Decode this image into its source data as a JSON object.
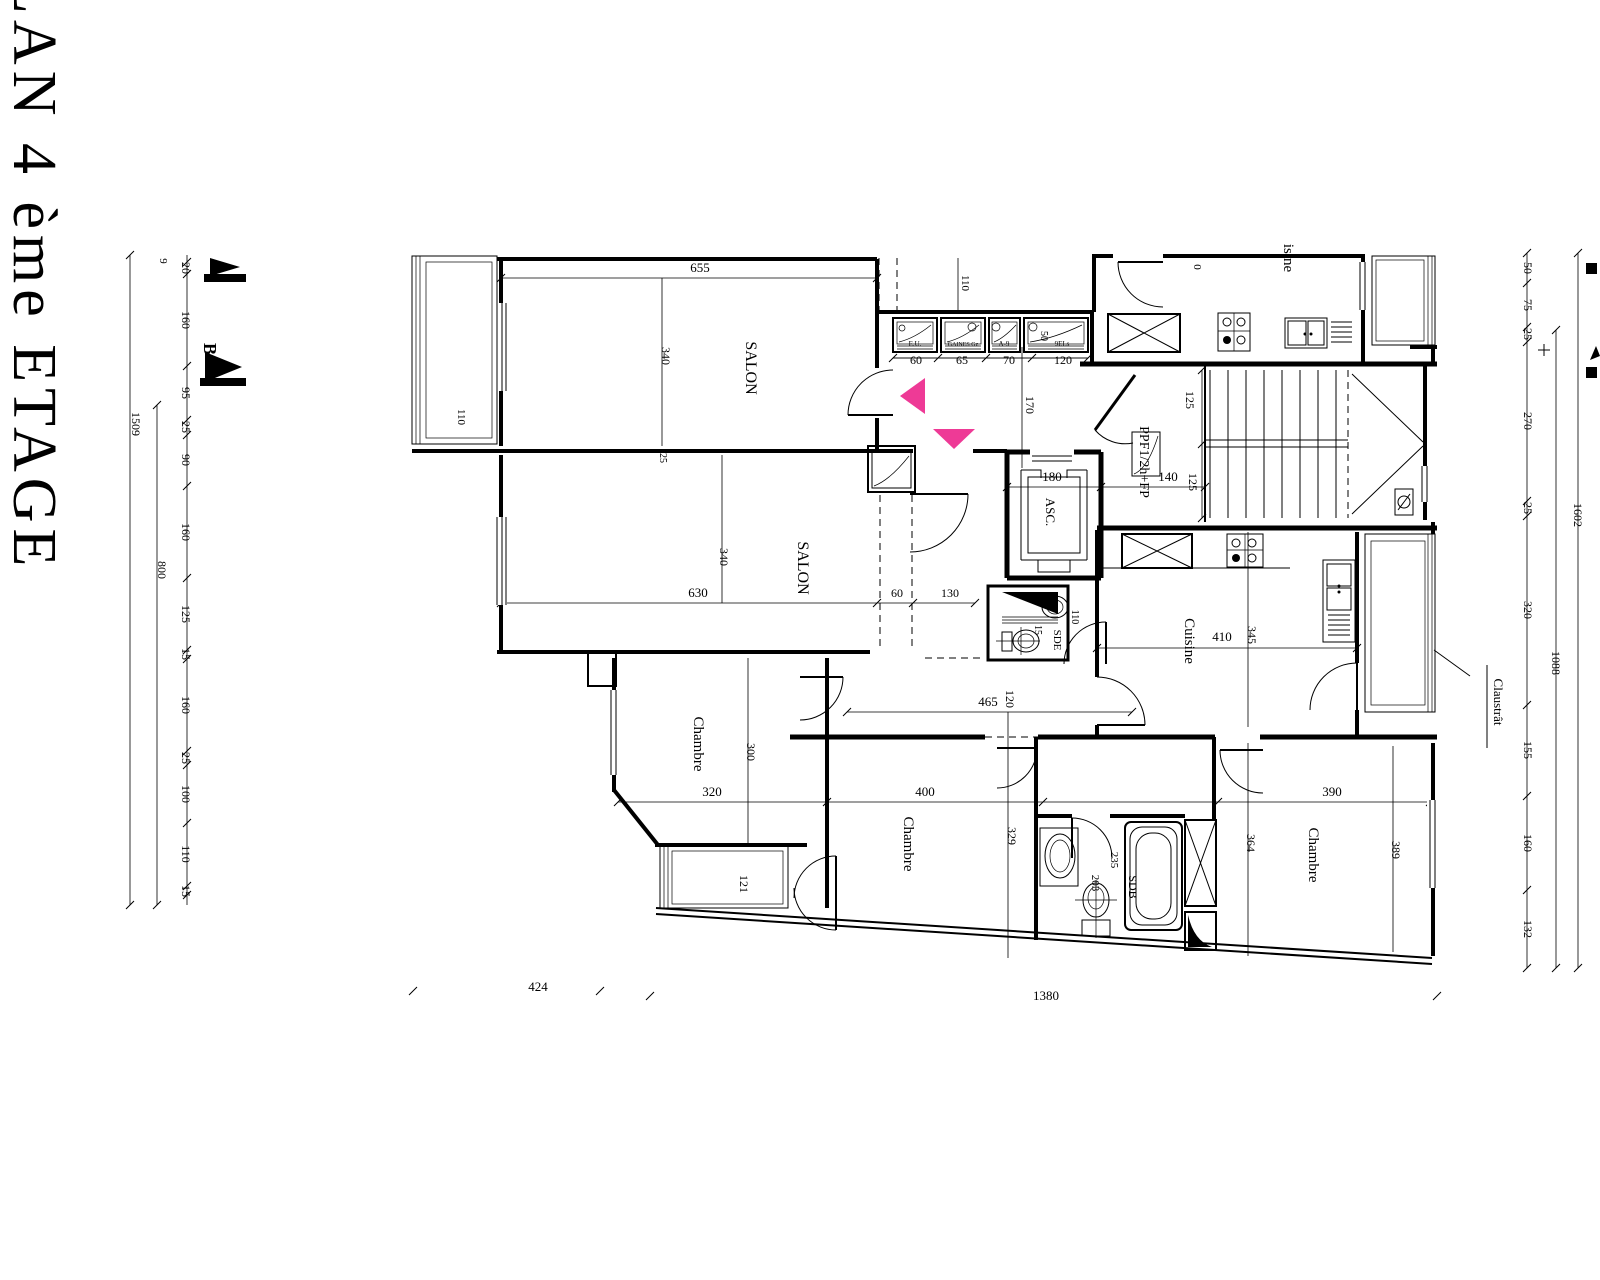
{
  "title": "PLAN 4 ème ETAGE",
  "colors": {
    "ink": "#000000",
    "background": "#ffffff",
    "highlight_arrow": "#ee3a96"
  },
  "drawing": {
    "labels": [
      {
        "n": "plan-title",
        "t": "PLAN 4 ème ETAGE",
        "x": 14,
        "y": 254,
        "r": 90,
        "s": 62,
        "ls": 6
      },
      {
        "n": "chain-total-1509",
        "t": "1509",
        "x": 132,
        "y": 424,
        "r": 90,
        "s": 12
      },
      {
        "n": "chain-total-800",
        "t": "800",
        "x": 158,
        "y": 570,
        "r": 90,
        "s": 12
      },
      {
        "n": "chain-partial-9",
        "t": "9",
        "x": 160,
        "y": 261,
        "r": 90,
        "s": 11
      },
      {
        "n": "section-marker-b",
        "t": "B",
        "x": 204,
        "y": 349,
        "r": 90,
        "s": 18,
        "w": "bold"
      },
      {
        "n": "chain-l-20",
        "t": "20",
        "x": 182,
        "y": 268,
        "r": 90,
        "s": 12
      },
      {
        "n": "chain-l-160a",
        "t": "160",
        "x": 182,
        "y": 320,
        "r": 90,
        "s": 12
      },
      {
        "n": "chain-l-95",
        "t": "95",
        "x": 182,
        "y": 393,
        "r": 90,
        "s": 12
      },
      {
        "n": "chain-l-25a",
        "t": "25",
        "x": 182,
        "y": 427,
        "r": 90,
        "s": 12
      },
      {
        "n": "chain-l-90",
        "t": "90",
        "x": 182,
        "y": 460,
        "r": 90,
        "s": 12
      },
      {
        "n": "chain-l-160b",
        "t": "160",
        "x": 182,
        "y": 532,
        "r": 90,
        "s": 12
      },
      {
        "n": "chain-l-125",
        "t": "125",
        "x": 182,
        "y": 614,
        "r": 90,
        "s": 12
      },
      {
        "n": "chain-l-15a",
        "t": "15",
        "x": 182,
        "y": 654,
        "r": 90,
        "s": 12
      },
      {
        "n": "chain-l-160c",
        "t": "160",
        "x": 182,
        "y": 705,
        "r": 90,
        "s": 12
      },
      {
        "n": "chain-l-25b",
        "t": "25",
        "x": 182,
        "y": 758,
        "r": 90,
        "s": 12
      },
      {
        "n": "chain-l-100",
        "t": "100",
        "x": 182,
        "y": 794,
        "r": 90,
        "s": 12
      },
      {
        "n": "chain-l-110",
        "t": "110",
        "x": 182,
        "y": 854,
        "r": 90,
        "s": 12
      },
      {
        "n": "chain-l-15b",
        "t": "15",
        "x": 182,
        "y": 891,
        "r": 90,
        "s": 12
      },
      {
        "n": "dim-655",
        "t": "655",
        "x": 700,
        "y": 272,
        "r": 0,
        "s": 13
      },
      {
        "n": "dim-110-balcony",
        "t": "110",
        "x": 458,
        "y": 417,
        "r": 90,
        "s": 11
      },
      {
        "n": "room-salon-1",
        "t": "SALON",
        "x": 746,
        "y": 368,
        "r": 90,
        "s": 16
      },
      {
        "n": "dim-340-salon1",
        "t": "340",
        "x": 662,
        "y": 356,
        "r": 90,
        "s": 12
      },
      {
        "n": "dim-110-top",
        "t": "110",
        "x": 962,
        "y": 283,
        "r": 90,
        "s": 11
      },
      {
        "n": "duct-label-1",
        "t": "E.U.",
        "x": 915,
        "y": 346,
        "r": 0,
        "s": 7
      },
      {
        "n": "duct-label-2",
        "t": "GAINES Gz",
        "x": 963,
        "y": 346,
        "r": 0,
        "s": 6
      },
      {
        "n": "duct-label-3",
        "t": "A-9",
        "x": 1004,
        "y": 346,
        "r": 0,
        "s": 7
      },
      {
        "n": "duct-label-4",
        "t": "9ELs",
        "x": 1062,
        "y": 346,
        "r": 0,
        "s": 7
      },
      {
        "n": "dim-50-duct",
        "t": "50",
        "x": 1041,
        "y": 336,
        "r": 90,
        "s": 10
      },
      {
        "n": "dim-duct-60",
        "t": "60",
        "x": 916,
        "y": 364,
        "r": 0,
        "s": 12
      },
      {
        "n": "dim-duct-65",
        "t": "65",
        "x": 962,
        "y": 364,
        "r": 0,
        "s": 12
      },
      {
        "n": "dim-duct-70",
        "t": "70",
        "x": 1009,
        "y": 364,
        "r": 0,
        "s": 12
      },
      {
        "n": "dim-duct-120",
        "t": "120",
        "x": 1063,
        "y": 364,
        "r": 0,
        "s": 12
      },
      {
        "n": "dim-170",
        "t": "170",
        "x": 1026,
        "y": 405,
        "r": 90,
        "s": 12
      },
      {
        "n": "dim-180-asc",
        "t": "180",
        "x": 1052,
        "y": 481,
        "r": 0,
        "s": 13
      },
      {
        "n": "dim-140",
        "t": "140",
        "x": 1168,
        "y": 481,
        "r": 0,
        "s": 13
      },
      {
        "n": "label-ppf",
        "t": "PPF1/2h+FP",
        "x": 1140,
        "y": 462,
        "r": 90,
        "s": 14
      },
      {
        "n": "dim-125-a",
        "t": "125",
        "x": 1186,
        "y": 400,
        "r": 90,
        "s": 12
      },
      {
        "n": "dim-125-b",
        "t": "125",
        "x": 1189,
        "y": 482,
        "r": 90,
        "s": 12
      },
      {
        "n": "dim-0-partial",
        "t": "0",
        "x": 1194,
        "y": 267,
        "r": 90,
        "s": 11
      },
      {
        "n": "room-cuisine-clipped",
        "t": "isine",
        "x": 1284,
        "y": 258,
        "r": 90,
        "s": 15
      },
      {
        "n": "label-asc",
        "t": "ASC.",
        "x": 1046,
        "y": 512,
        "r": 90,
        "s": 13
      },
      {
        "n": "room-salon-2",
        "t": "SALON",
        "x": 798,
        "y": 568,
        "r": 90,
        "s": 16
      },
      {
        "n": "dim-630",
        "t": "630",
        "x": 698,
        "y": 597,
        "r": 0,
        "s": 13
      },
      {
        "n": "dim-340-salon2",
        "t": "340",
        "x": 720,
        "y": 557,
        "r": 90,
        "s": 12
      },
      {
        "n": "dim-25-wall",
        "t": "25",
        "x": 660,
        "y": 458,
        "r": 90,
        "s": 10
      },
      {
        "n": "dim-60",
        "t": "60",
        "x": 897,
        "y": 597,
        "r": 0,
        "s": 12
      },
      {
        "n": "dim-130",
        "t": "130",
        "x": 950,
        "y": 597,
        "r": 0,
        "s": 12
      },
      {
        "n": "room-sde",
        "t": "SDE",
        "x": 1054,
        "y": 640,
        "r": 90,
        "s": 11
      },
      {
        "n": "dim-110-sde",
        "t": "110",
        "x": 1072,
        "y": 617,
        "r": 90,
        "s": 10
      },
      {
        "n": "dim-15-sde",
        "t": "15",
        "x": 1035,
        "y": 630,
        "r": 90,
        "s": 10
      },
      {
        "n": "room-cuisine",
        "t": "Cuisine",
        "x": 1185,
        "y": 641,
        "r": 90,
        "s": 15
      },
      {
        "n": "dim-410",
        "t": "410",
        "x": 1222,
        "y": 641,
        "r": 0,
        "s": 13
      },
      {
        "n": "dim-345",
        "t": "345",
        "x": 1248,
        "y": 635,
        "r": 90,
        "s": 12
      },
      {
        "n": "dim-465",
        "t": "465",
        "x": 988,
        "y": 706,
        "r": 0,
        "s": 13
      },
      {
        "n": "dim-120-hall",
        "t": "120",
        "x": 1006,
        "y": 699,
        "r": 90,
        "s": 12
      },
      {
        "n": "room-chambre-1",
        "t": "Chambre",
        "x": 694,
        "y": 744,
        "r": 90,
        "s": 15
      },
      {
        "n": "dim-300",
        "t": "300",
        "x": 747,
        "y": 752,
        "r": 90,
        "s": 12
      },
      {
        "n": "dim-320-ch1",
        "t": "320",
        "x": 712,
        "y": 796,
        "r": 0,
        "s": 13
      },
      {
        "n": "dim-400",
        "t": "400",
        "x": 925,
        "y": 796,
        "r": 0,
        "s": 13
      },
      {
        "n": "dim-390",
        "t": "390",
        "x": 1332,
        "y": 796,
        "r": 0,
        "s": 13
      },
      {
        "n": "dim-329",
        "t": "329",
        "x": 1008,
        "y": 836,
        "r": 90,
        "s": 12
      },
      {
        "n": "dim-364",
        "t": "364",
        "x": 1247,
        "y": 843,
        "r": 90,
        "s": 12
      },
      {
        "n": "dim-389",
        "t": "389",
        "x": 1392,
        "y": 850,
        "r": 90,
        "s": 12
      },
      {
        "n": "room-chambre-2",
        "t": "Chambre",
        "x": 904,
        "y": 844,
        "r": 90,
        "s": 15
      },
      {
        "n": "room-chambre-3",
        "t": "Chambre",
        "x": 1309,
        "y": 855,
        "r": 90,
        "s": 15
      },
      {
        "n": "room-sdb",
        "t": "SDB",
        "x": 1129,
        "y": 887,
        "r": 90,
        "s": 12
      },
      {
        "n": "dim-203",
        "t": "203",
        "x": 1092,
        "y": 883,
        "r": 90,
        "s": 11
      },
      {
        "n": "dim-235",
        "t": "235",
        "x": 1111,
        "y": 860,
        "r": 90,
        "s": 11
      },
      {
        "n": "dim-121-balcony",
        "t": "121",
        "x": 740,
        "y": 884,
        "r": 90,
        "s": 12
      },
      {
        "n": "label-claustra",
        "t": "Claustrât",
        "x": 1494,
        "y": 702,
        "r": 90,
        "s": 13
      },
      {
        "n": "dim-424",
        "t": "424",
        "x": 538,
        "y": 991,
        "r": 0,
        "s": 13
      },
      {
        "n": "dim-1380",
        "t": "1380",
        "x": 1046,
        "y": 1000,
        "r": 0,
        "s": 13
      },
      {
        "n": "chain-r-50",
        "t": "50",
        "x": 1524,
        "y": 268,
        "r": 90,
        "s": 12
      },
      {
        "n": "chain-r-75",
        "t": "75",
        "x": 1524,
        "y": 305,
        "r": 90,
        "s": 12
      },
      {
        "n": "chain-r-25a",
        "t": "25",
        "x": 1524,
        "y": 334,
        "r": 90,
        "s": 12
      },
      {
        "n": "chain-r-270",
        "t": "270",
        "x": 1524,
        "y": 421,
        "r": 90,
        "s": 12
      },
      {
        "n": "chain-r-25b",
        "t": "25",
        "x": 1524,
        "y": 508,
        "r": 90,
        "s": 12
      },
      {
        "n": "chain-r-320",
        "t": "320",
        "x": 1524,
        "y": 610,
        "r": 90,
        "s": 12
      },
      {
        "n": "chain-r-155",
        "t": "155",
        "x": 1524,
        "y": 750,
        "r": 90,
        "s": 12
      },
      {
        "n": "chain-r-160",
        "t": "160",
        "x": 1524,
        "y": 843,
        "r": 90,
        "s": 12
      },
      {
        "n": "chain-r-132",
        "t": "132",
        "x": 1524,
        "y": 929,
        "r": 90,
        "s": 12
      },
      {
        "n": "chain-total-1088",
        "t": "1088",
        "x": 1552,
        "y": 663,
        "r": 90,
        "s": 12
      },
      {
        "n": "chain-total-1602",
        "t": "1602",
        "x": 1574,
        "y": 515,
        "r": 90,
        "s": 12
      }
    ]
  }
}
